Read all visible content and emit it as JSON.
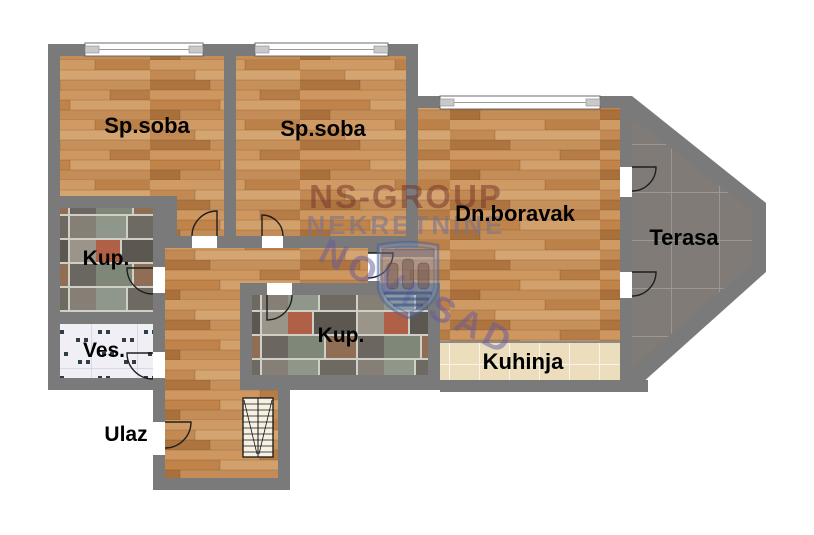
{
  "plan": {
    "type": "apartment-floor-plan",
    "rooms": {
      "bedroom1": {
        "label": "Sp.soba"
      },
      "bedroom2": {
        "label": "Sp.soba"
      },
      "living": {
        "label": "Dn.boravak"
      },
      "terrace": {
        "label": "Terasa"
      },
      "bath_left": {
        "label": "Kup."
      },
      "laundry": {
        "label": "Ves."
      },
      "bath_main": {
        "label": "Kup."
      },
      "kitchen": {
        "label": "Kuhinja"
      },
      "entrance": {
        "label": "Ulaz"
      }
    },
    "watermark": {
      "brand_line1": "NS-GROUP",
      "brand_line2": "NEKRETNINE",
      "city": "NOVI SAD",
      "logo": "shield-castle-logo"
    },
    "colors": {
      "wall": "#7a7a7a",
      "wood_floor": "#c98f58",
      "terrace_tile": "#807b76",
      "kitchen_tile": "#ecdebc",
      "laundry_tile": "#f0eff6",
      "stone_tile_grout": "#cfcfc8",
      "watermark_red": "rgba(112,48,40,0.5)",
      "watermark_gray": "rgba(120,115,140,0.6)",
      "watermark_purple": "rgba(100,88,158,0.5)",
      "logo_blue": "rgba(130,160,210,0.32)"
    }
  }
}
